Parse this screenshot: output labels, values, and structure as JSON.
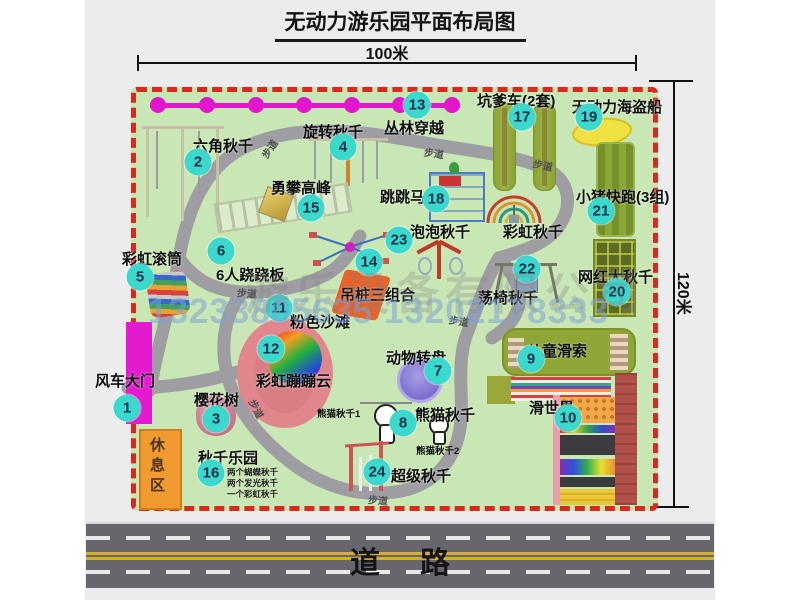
{
  "title": "无动力游乐园平面布局图",
  "dimensions": {
    "top": "100米",
    "right": "120米"
  },
  "road": {
    "label": "道路"
  },
  "watermark": {
    "company": "游乐设备有限公司",
    "phone": "13233805635 13202178333"
  },
  "colors": {
    "badge": "#3bd8cd",
    "map_grass": "#c9e7b4",
    "border_red": "#da281c",
    "path_gray": "#9e9ea2",
    "zipline_magenta": "#e316ce",
    "road_gray": "#66666c"
  },
  "walk_labels": {
    "text": "步道",
    "positions": [
      [
        259,
        141,
        -55
      ],
      [
        424,
        145,
        8
      ],
      [
        533,
        157,
        12
      ],
      [
        237,
        285,
        4
      ],
      [
        449,
        313,
        10
      ],
      [
        247,
        401,
        62
      ],
      [
        368,
        492,
        5
      ]
    ]
  },
  "zipline": {
    "y": 105,
    "dots": [
      158,
      207,
      256,
      304,
      352,
      400,
      452
    ]
  },
  "items": [
    {
      "n": "1",
      "label": "风车大门",
      "l": [
        95,
        370
      ],
      "b": [
        127,
        408
      ]
    },
    {
      "n": "2",
      "label": "六角秋千",
      "l": [
        193,
        135
      ],
      "b": [
        198,
        162
      ]
    },
    {
      "n": "3",
      "label": "樱花树",
      "l": [
        194,
        389
      ],
      "b": [
        216,
        419
      ]
    },
    {
      "n": "4",
      "label": "旋转秋千",
      "l": [
        303,
        121
      ],
      "b": [
        343,
        147
      ]
    },
    {
      "n": "5",
      "label": "彩虹滚筒",
      "l": [
        122,
        248
      ],
      "b": [
        140,
        277
      ]
    },
    {
      "n": "6",
      "label": "6人跷跷板",
      "l": [
        216,
        264
      ],
      "b": [
        221,
        251
      ]
    },
    {
      "n": "7",
      "label": "动物转盘",
      "l": [
        386,
        347
      ],
      "b": [
        438,
        371
      ]
    },
    {
      "n": "8",
      "label": "熊猫秋千",
      "l": [
        415,
        404
      ],
      "b": [
        403,
        423
      ]
    },
    {
      "n": "9",
      "label": "儿童滑索",
      "l": [
        527,
        340
      ],
      "b": [
        531,
        359
      ]
    },
    {
      "n": "10",
      "label": "滑世界",
      "l": [
        529,
        397
      ],
      "b": [
        568,
        418
      ]
    },
    {
      "n": "11",
      "label": "粉色沙滩",
      "l": [
        290,
        311
      ],
      "b": [
        279,
        308
      ]
    },
    {
      "n": "12",
      "label": "彩虹蹦蹦云",
      "l": [
        256,
        370
      ],
      "b": [
        271,
        349
      ]
    },
    {
      "n": "13",
      "label": "丛林穿越",
      "l": [
        384,
        117
      ],
      "b": [
        417,
        105
      ]
    },
    {
      "n": "14",
      "label": "吊桩三组合",
      "l": [
        340,
        284
      ],
      "b": [
        369,
        262
      ]
    },
    {
      "n": "15",
      "label": "勇攀高峰",
      "l": [
        271,
        177
      ],
      "b": [
        311,
        208
      ]
    },
    {
      "n": "16",
      "label": "秋千乐园",
      "l": [
        198,
        447
      ],
      "b": [
        211,
        473
      ],
      "sub": [
        "两个蝴蝶秋千",
        "两个发光秋千",
        "一个彩虹秋千"
      ],
      "sub_pos": [
        227,
        466
      ]
    },
    {
      "n": "17",
      "label": "坑爹车(2套)",
      "l": [
        477,
        90
      ],
      "b": [
        522,
        117
      ]
    },
    {
      "n": "18",
      "label": "跳跳马",
      "l": [
        380,
        186
      ],
      "b": [
        436,
        199
      ]
    },
    {
      "n": "19",
      "label": "无动力海盗船",
      "l": [
        572,
        96
      ],
      "b": [
        589,
        117
      ]
    },
    {
      "n": "20",
      "label": "网红大秋千",
      "l": [
        578,
        266
      ],
      "b": [
        617,
        292
      ]
    },
    {
      "n": "21",
      "label": "小猪快跑(3组)",
      "l": [
        576,
        186
      ],
      "b": [
        601,
        211
      ]
    },
    {
      "n": "22",
      "label": "荡椅秋千",
      "l": [
        478,
        287
      ],
      "b": [
        527,
        269
      ]
    },
    {
      "n": "23",
      "label": "泡泡秋千",
      "l": [
        410,
        221
      ],
      "b": [
        399,
        240
      ]
    },
    {
      "n": "24",
      "label": "超级秋千",
      "l": [
        391,
        465
      ],
      "b": [
        377,
        472
      ]
    }
  ],
  "extra_labels": [
    {
      "t": "彩虹秋千",
      "x": 503,
      "y": 221,
      "cls": "lbl",
      "name": "label-rainbow-swing"
    },
    {
      "t": "熊猫秋千1",
      "x": 317,
      "y": 406,
      "cls": "lbl-sm",
      "name": "label-panda-swing-1"
    },
    {
      "t": "熊猫秋千2",
      "x": 416,
      "y": 443,
      "cls": "lbl-sm",
      "name": "label-panda-swing-2"
    },
    {
      "t": "休息区",
      "x": 146,
      "y": 437,
      "cls": "lbl-vert",
      "name": "label-rest-area"
    }
  ]
}
